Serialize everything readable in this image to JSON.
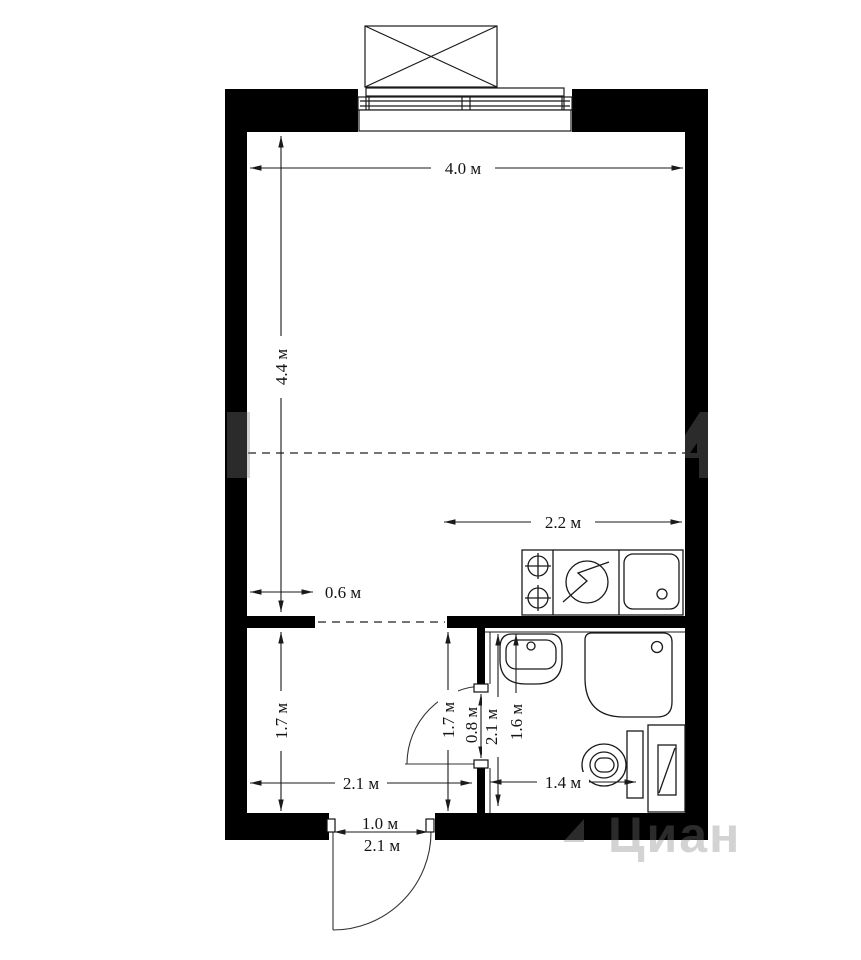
{
  "dimensions": {
    "main_width": "4.0 м",
    "main_depth": "4.4 м",
    "kitchen_width": "2.2 м",
    "ledge_width": "0.6 м",
    "hall_depth_left": "1.7 м",
    "hall_depth_right": "1.7 м",
    "hall_width": "2.1 м",
    "bath_door_width": "0.8 м",
    "bath_depth": "2.1 м",
    "bath_sink_zone": "1.6 м",
    "bath_width": "1.4 м",
    "entry_door_width": "1.0 м",
    "entry_wall_width": "2.1 м"
  },
  "watermark": {
    "brand": "Циан"
  }
}
